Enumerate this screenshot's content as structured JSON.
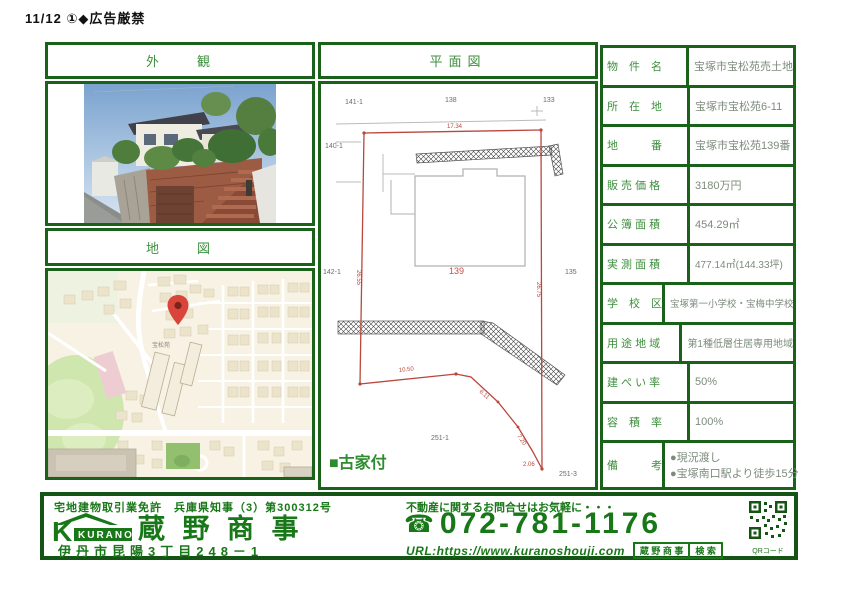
{
  "page": {
    "note": "11/12 ①◆広告厳禁"
  },
  "sections": {
    "exterior": "外　　観",
    "map": "地　　図",
    "plan": "平面図"
  },
  "plan": {
    "note": "■古家付",
    "lots": {
      "top_left": "141-1",
      "top_center": "138",
      "top_right": "133",
      "upper_left": "140-1",
      "mid_left": "142-1",
      "center": "139",
      "mid_right": "135",
      "bottom_center": "251-1",
      "bottom_right": "251-3"
    },
    "dims": {
      "top": "17.34",
      "left": "26.55",
      "right": "26.75",
      "bottom1": "10.50",
      "bottom2": "6.11",
      "bottom3": "7.20",
      "bottom4": "2.06"
    }
  },
  "map": {
    "area_label": "宝松苑"
  },
  "details": {
    "rows": [
      {
        "label": "物　件　名",
        "value": "宝塚市宝松苑売土地"
      },
      {
        "label": "所　在　地",
        "value": "宝塚市宝松苑6-11"
      },
      {
        "label": "地　　　番",
        "value": "宝塚市宝松苑139番"
      },
      {
        "label": "販 売 価 格",
        "value": "3180万円"
      },
      {
        "label": "公 簿 面 積",
        "value": "454.29㎡"
      },
      {
        "label": "実 測 面 積",
        "value": "477.14㎡(144.33坪)"
      },
      {
        "label": "学　校　区",
        "value": "宝塚第一小学校・宝梅中学校"
      },
      {
        "label": "用 途 地 域",
        "value": "第1種低層住居専用地域"
      },
      {
        "label": "建 ぺ い 率",
        "value": "50%"
      },
      {
        "label": "容　積　率",
        "value": "100%"
      },
      {
        "label": "備　　　考",
        "value": "●現況渡し",
        "value2": "●宝塚南口駅より徒歩15分"
      }
    ]
  },
  "footer": {
    "license": "宅地建物取引業免許　兵庫県知事（3）第300312号",
    "logo_text": "KURANO",
    "company": "蔵 野 商 事",
    "address": "伊丹市昆陽3丁目248－1",
    "contact_note": "不動産に関するお問合せはお気軽に・・・",
    "phone_icon": "☎",
    "phone": "072-781-1176",
    "url": "URL:https://www.kuranoshouji.com",
    "search_brand": "蔵 野 商 事",
    "search_button": "検 索",
    "qr_caption": "QRコード"
  },
  "colors": {
    "border_green": "#1a621a",
    "label_green": "#3e8e3e",
    "footer_green": "#187818",
    "plan_red": "#b9473c",
    "pin_red": "#d9453a"
  }
}
